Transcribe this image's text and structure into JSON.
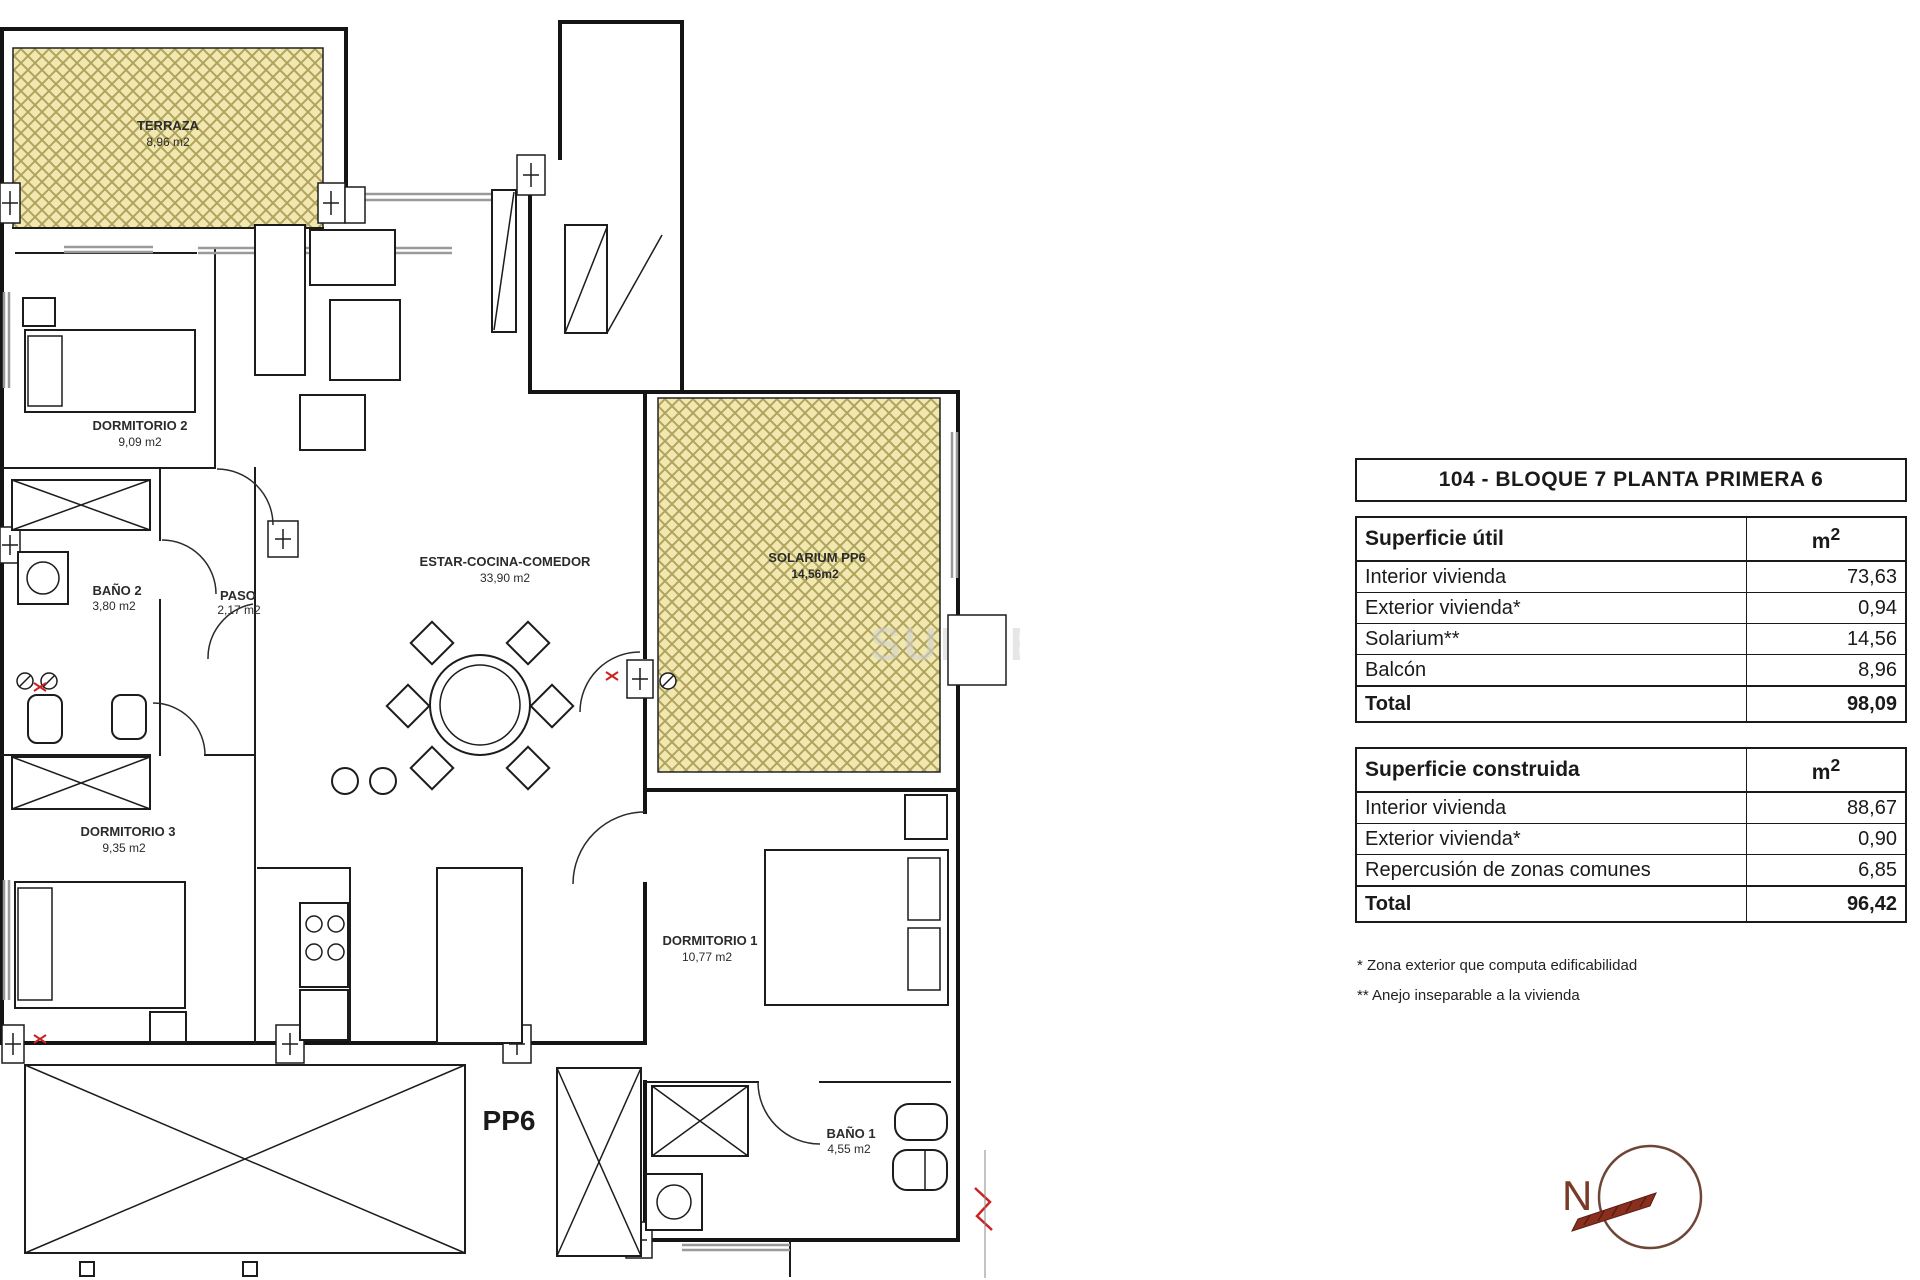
{
  "panel": {
    "title": "104 - BLOQUE 7 PLANTA PRIMERA 6",
    "unit": "m",
    "unit_sup": "2",
    "util": {
      "header": "Superficie útil",
      "rows": [
        {
          "label": "Interior vivienda",
          "value": "73,63"
        },
        {
          "label": "Exterior vivienda*",
          "value": "0,94"
        },
        {
          "label": "Solarium**",
          "value": "14,56"
        },
        {
          "label": "Balcón",
          "value": "8,96"
        }
      ],
      "total": {
        "label": "Total",
        "value": "98,09"
      }
    },
    "built": {
      "header": "Superficie construida",
      "rows": [
        {
          "label": "Interior vivienda",
          "value": "88,67"
        },
        {
          "label": "Exterior vivienda*",
          "value": "0,90"
        },
        {
          "label": "Repercusión de zonas comunes",
          "value": "6,85"
        }
      ],
      "total": {
        "label": "Total",
        "value": "96,42"
      }
    },
    "footnotes": [
      "* Zona exterior que computa edificabilidad",
      "** Anejo inseparable a la vivienda"
    ]
  },
  "plan": {
    "rooms": [
      {
        "name": "TERRAZA",
        "area": "8,96 m2"
      },
      {
        "name": "DORMITORIO 2",
        "area": "9,09 m2"
      },
      {
        "name": "BAÑO 2",
        "area": "3,80 m2"
      },
      {
        "name": "PASO",
        "area": "2,17 m2"
      },
      {
        "name": "ESTAR-COCINA-COMEDOR",
        "area": "33,90 m2"
      },
      {
        "name": "SOLARIUM PP6",
        "area": "14,56m2"
      },
      {
        "name": "DORMITORIO 3",
        "area": "9,35 m2"
      },
      {
        "name": "DORMITORIO 1",
        "area": "10,77 m2"
      },
      {
        "name": "BAÑO 1",
        "area": "4,55 m2"
      }
    ],
    "unit_label": "PP6",
    "compass_letter": "N",
    "watermark": "SUNSET"
  },
  "colors": {
    "hatch_fill": "#f1e8b0",
    "hatch_line": "#b1a35e",
    "wall": "#1a1a1a",
    "window_gray": "#9a9a9a",
    "compass_red": "#8a2e1e",
    "red_mark": "#cc2222"
  }
}
